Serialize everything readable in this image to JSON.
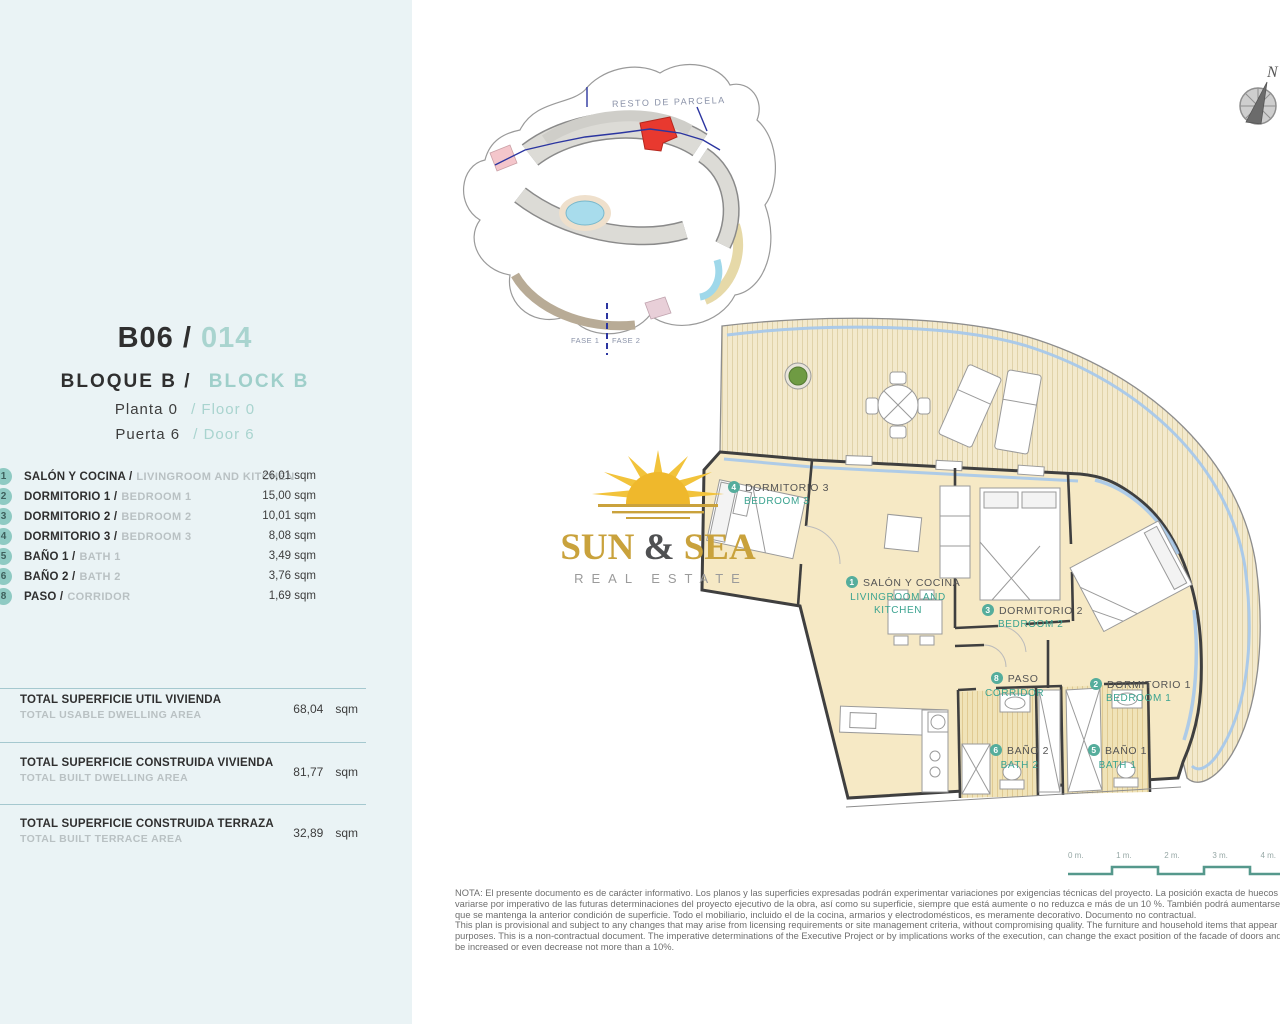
{
  "sidebar": {
    "unit_code": "B06 /",
    "unit_number": "014",
    "block_es": "BLOQUE B /",
    "block_en": "BLOCK B",
    "floor_es": "Planta 0",
    "floor_en": "/ Floor 0",
    "door_es": "Puerta 6",
    "door_en": "/ Door 6",
    "rooms": [
      {
        "num": "1",
        "name_es": "SALÓN Y COCINA /",
        "name_en": "LIVINGROOM AND KITCHEN",
        "area": "26,01 sqm"
      },
      {
        "num": "2",
        "name_es": "DORMITORIO 1 /",
        "name_en": "BEDROOM 1",
        "area": "15,00 sqm"
      },
      {
        "num": "3",
        "name_es": "DORMITORIO 2 /",
        "name_en": "BEDROOM 2",
        "area": "10,01 sqm"
      },
      {
        "num": "4",
        "name_es": "DORMITORIO 3 /",
        "name_en": "BEDROOM 3",
        "area": "8,08 sqm"
      },
      {
        "num": "5",
        "name_es": "BAÑO 1 /",
        "name_en": "BATH 1",
        "area": "3,49 sqm"
      },
      {
        "num": "6",
        "name_es": "BAÑO 2 /",
        "name_en": "BATH 2",
        "area": "3,76 sqm"
      },
      {
        "num": "8",
        "name_es": "PASO /",
        "name_en": "CORRIDOR",
        "area": "1,69 sqm"
      }
    ],
    "totals": [
      {
        "title_es": "TOTAL SUPERFICIE UTIL VIVIENDA",
        "title_en": "TOTAL USABLE DWELLING AREA",
        "value": "68,04",
        "unit": "sqm"
      },
      {
        "title_es": "TOTAL SUPERFICIE CONSTRUIDA VIVIENDA",
        "title_en": "TOTAL BUILT DWELLING AREA",
        "value": "81,77",
        "unit": "sqm"
      },
      {
        "title_es": "TOTAL SUPERFICIE CONSTRUIDA TERRAZA",
        "title_en": "TOTAL BUILT TERRACE AREA",
        "value": "32,89",
        "unit": "sqm"
      }
    ]
  },
  "site_plan": {
    "label_resto": "RESTO DE PARCELA",
    "label_fase1": "FASE 1",
    "label_fase2": "FASE 2"
  },
  "compass": {
    "north_label": "N"
  },
  "logo": {
    "name_left": "SUN ",
    "amp": "&",
    "name_right": " SEA",
    "subtitle": "REAL ESTATE"
  },
  "floor_plan": {
    "rooms": [
      {
        "num": "4",
        "name_es": "DORMITORIO 3",
        "name_en": "BEDROOM 3"
      },
      {
        "num": "1",
        "name_es": "SALÓN Y COCINA",
        "name_en": "LIVINGROOM AND KITCHEN"
      },
      {
        "num": "3",
        "name_es": "DORMITORIO 2",
        "name_en": "BEDROOM 2"
      },
      {
        "num": "8",
        "name_es": "PASO",
        "name_en": "CORRIDOR"
      },
      {
        "num": "2",
        "name_es": "DORMITORIO 1",
        "name_en": "BEDROOM 1"
      },
      {
        "num": "6",
        "name_es": "BAÑO 2",
        "name_en": "BATH 2"
      },
      {
        "num": "5",
        "name_es": "BAÑO 1",
        "name_en": "BATH 1"
      }
    ]
  },
  "scale_bar": {
    "labels": [
      "0 m.",
      "1 m.",
      "2 m.",
      "3 m.",
      "4 m."
    ]
  },
  "disclaimer": {
    "es": "NOTA: El presente documento es de carácter informativo. Los planos y las superficies expresadas podrán experimentar variaciones por exigencias técnicas del proyecto. La posición exacta de huecos de fachada (puertas y ventanas) podrá variarse por imperativo de las futuras determinaciones del proyecto ejecutivo de la obra, así como su superficie, siempre que está aumente o no reduzca e más de un 10 %. También podrá aumentarse su número, incluso, disminuirse, siempre que se mantenga la anterior condición de superficie. Todo el mobiliario, incluido el de la cocina, armarios y electrodomésticos, es meramente decorativo. Documento no contractual.",
    "en": "This plan is provisional and subject to any changes that may arise from licensing requirements or site management criteria, without compromising quality. The furniture and household items that appear in the plan are merely for decorative purposes. This is a non-contractual document. The imperative determinations of the Executive Project or by implications works of the execution, can change the exact position of the facade of doors and windows, as well the surface area may also be increased or even decrease not more than a 10%."
  },
  "colors": {
    "sidebar_bg": "#eaf3f5",
    "teal_accent": "#8fcac3",
    "plan_teal_text": "#3ba390",
    "room_fill": "#f6e9c5",
    "glass_blue": "#a6c8ea",
    "highlight_red": "#e8392f",
    "logo_gold": "#c9a23c"
  }
}
